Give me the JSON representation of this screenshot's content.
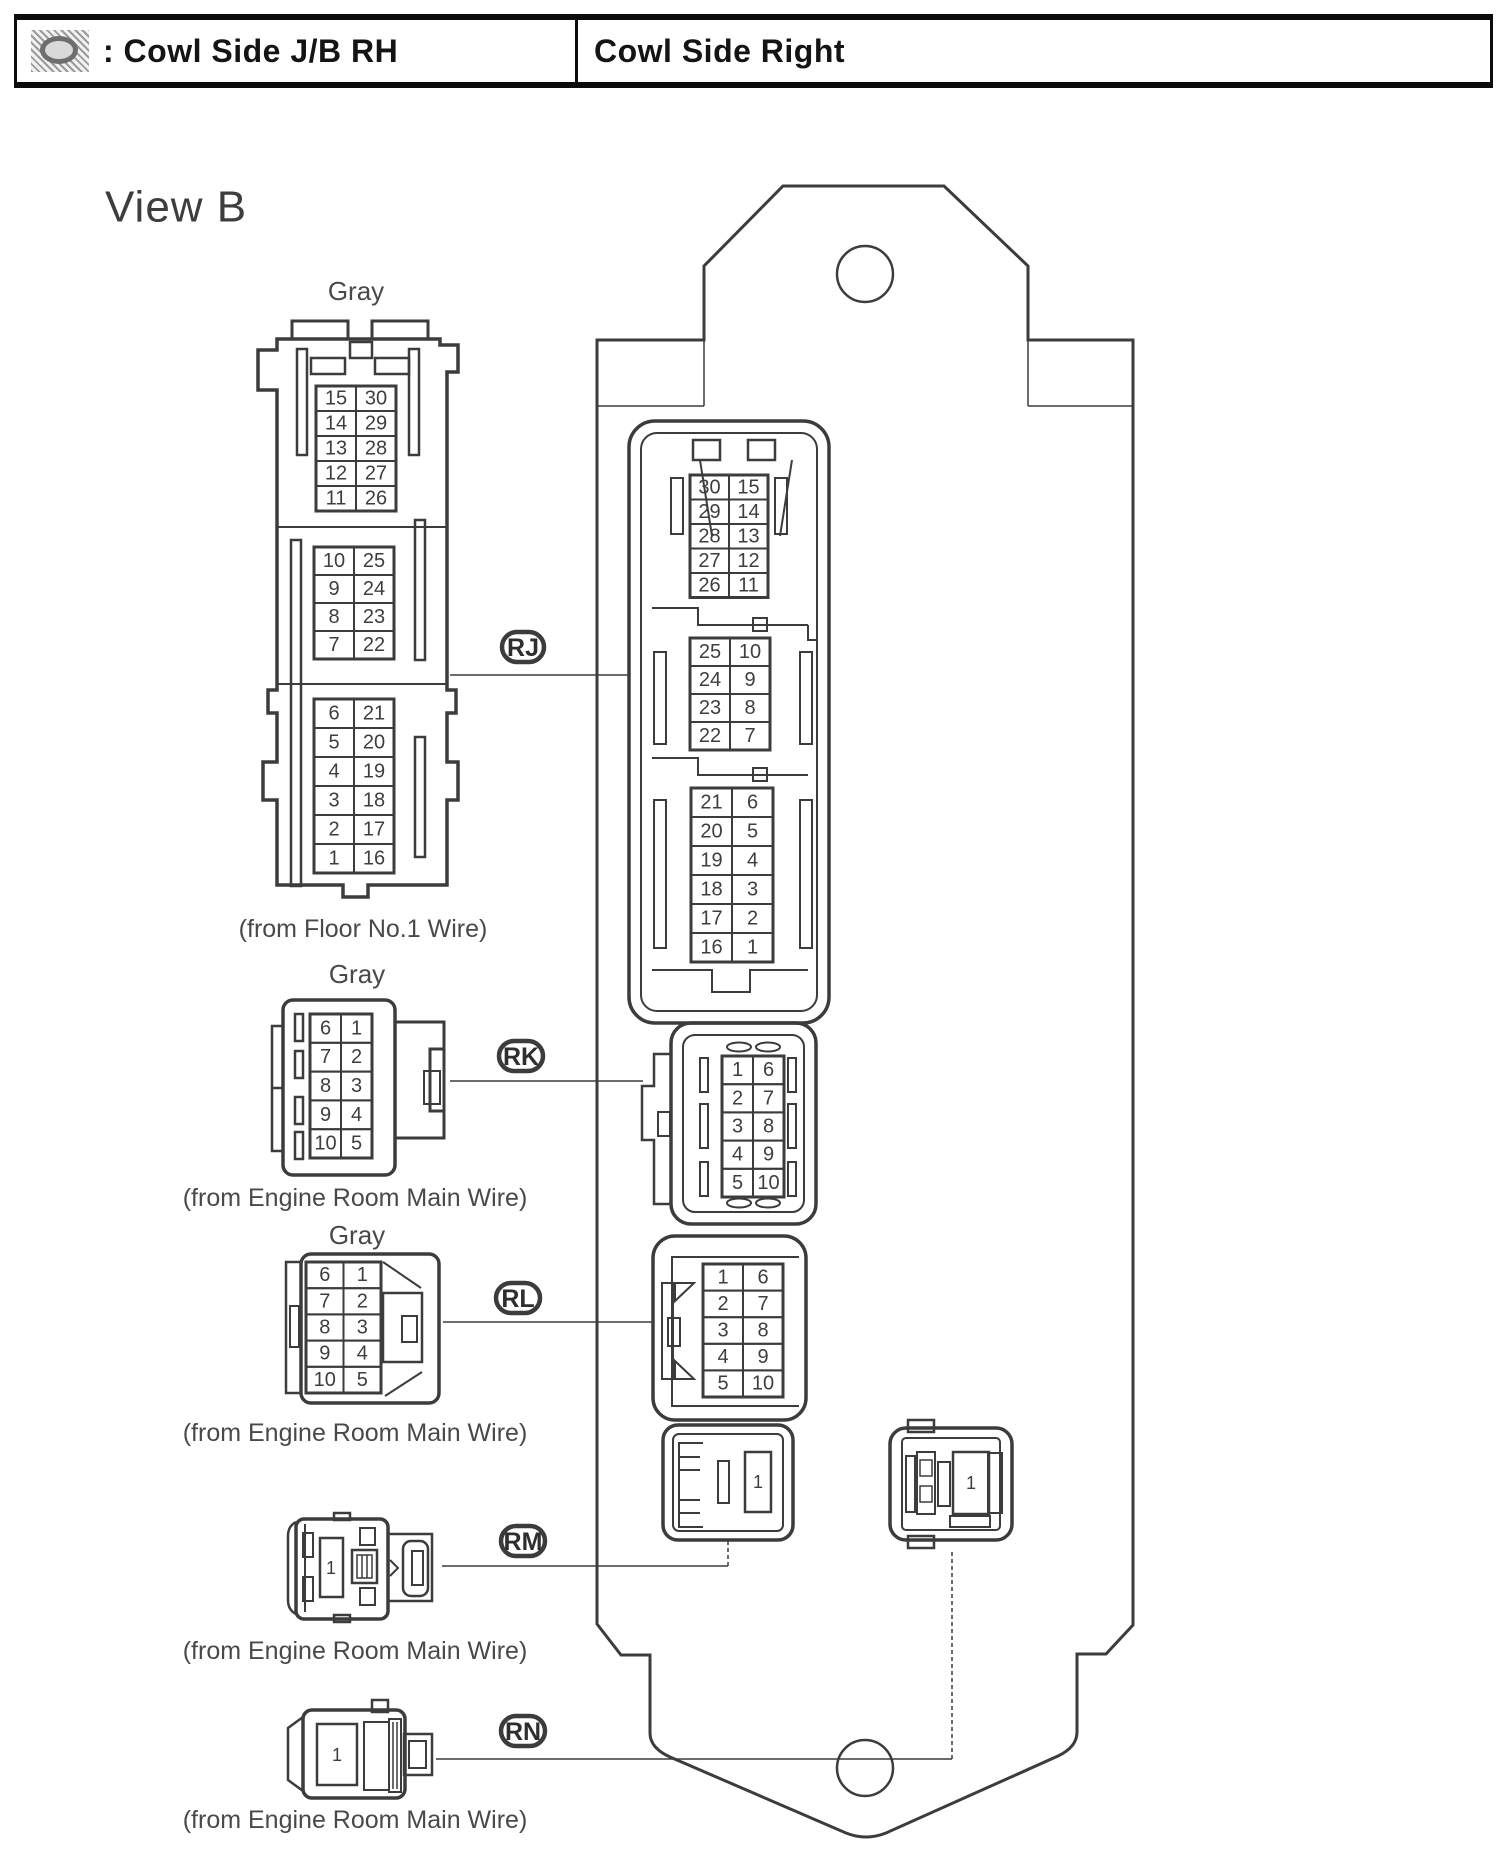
{
  "header": {
    "icon": "junction-block-symbol-icon",
    "symbol_label": ": Cowl Side J/B RH",
    "location_label": "Cowl Side Right"
  },
  "view_label": "View B",
  "connector_labels": {
    "rj": "RJ",
    "rk": "RK",
    "rl": "RL",
    "rm": "RM",
    "rn": "RN"
  },
  "harness_connectors": {
    "rj_mate": {
      "color_label": "Gray",
      "caption": "(from Floor No.1 Wire)",
      "sections": [
        {
          "rows": [
            [
              "15",
              "30"
            ],
            [
              "14",
              "29"
            ],
            [
              "13",
              "28"
            ],
            [
              "12",
              "27"
            ],
            [
              "11",
              "26"
            ]
          ]
        },
        {
          "rows": [
            [
              "10",
              "25"
            ],
            [
              "9",
              "24"
            ],
            [
              "8",
              "23"
            ],
            [
              "7",
              "22"
            ]
          ]
        },
        {
          "rows": [
            [
              "6",
              "21"
            ],
            [
              "5",
              "20"
            ],
            [
              "4",
              "19"
            ],
            [
              "3",
              "18"
            ],
            [
              "2",
              "17"
            ],
            [
              "1",
              "16"
            ]
          ]
        }
      ]
    },
    "rk_mate": {
      "color_label": "Gray",
      "caption": "(from Engine Room Main Wire)",
      "rows": [
        [
          "6",
          "1"
        ],
        [
          "7",
          "2"
        ],
        [
          "8",
          "3"
        ],
        [
          "9",
          "4"
        ],
        [
          "10",
          "5"
        ]
      ]
    },
    "rl_mate": {
      "color_label": "Gray",
      "caption": "(from Engine Room Main Wire)",
      "rows": [
        [
          "6",
          "1"
        ],
        [
          "7",
          "2"
        ],
        [
          "8",
          "3"
        ],
        [
          "9",
          "4"
        ],
        [
          "10",
          "5"
        ]
      ]
    },
    "rm_mate": {
      "caption": "(from Engine Room Main Wire)",
      "pin": "1"
    },
    "rn_mate": {
      "caption": "(from Engine Room Main Wire)",
      "pin": "1"
    }
  },
  "junction_block": {
    "rj": {
      "sections": [
        {
          "rows": [
            [
              "30",
              "15"
            ],
            [
              "29",
              "14"
            ],
            [
              "28",
              "13"
            ],
            [
              "27",
              "12"
            ],
            [
              "26",
              "11"
            ]
          ]
        },
        {
          "rows": [
            [
              "25",
              "10"
            ],
            [
              "24",
              "9"
            ],
            [
              "23",
              "8"
            ],
            [
              "22",
              "7"
            ]
          ]
        },
        {
          "rows": [
            [
              "21",
              "6"
            ],
            [
              "20",
              "5"
            ],
            [
              "19",
              "4"
            ],
            [
              "18",
              "3"
            ],
            [
              "17",
              "2"
            ],
            [
              "16",
              "1"
            ]
          ]
        }
      ]
    },
    "rk": {
      "rows": [
        [
          "1",
          "6"
        ],
        [
          "2",
          "7"
        ],
        [
          "3",
          "8"
        ],
        [
          "4",
          "9"
        ],
        [
          "5",
          "10"
        ]
      ]
    },
    "rl": {
      "rows": [
        [
          "1",
          "6"
        ],
        [
          "2",
          "7"
        ],
        [
          "3",
          "8"
        ],
        [
          "4",
          "9"
        ],
        [
          "5",
          "10"
        ]
      ]
    },
    "rm": {
      "pin": "1"
    },
    "rn": {
      "pin": "1"
    }
  }
}
